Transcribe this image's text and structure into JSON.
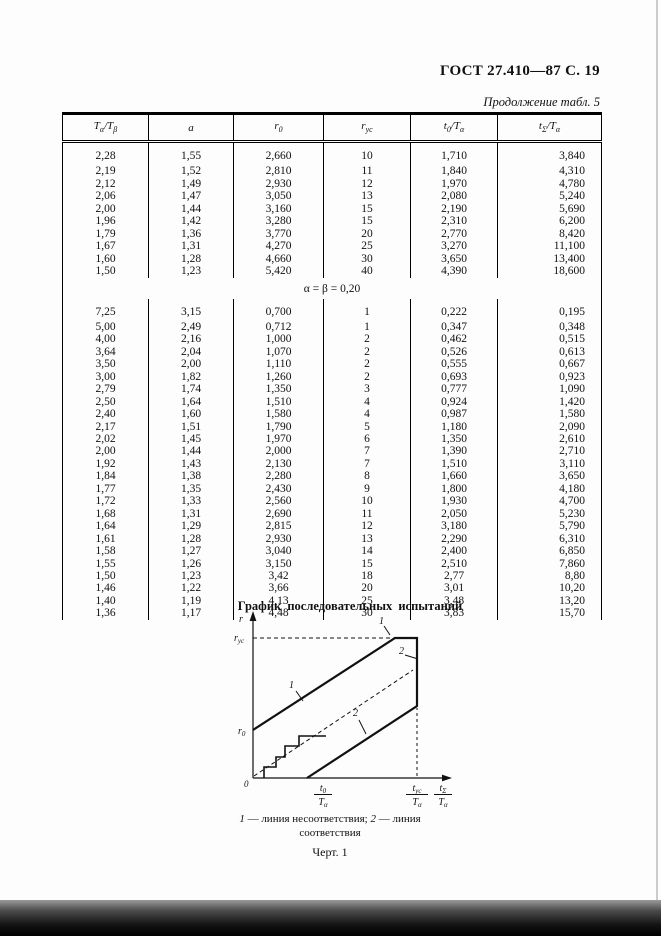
{
  "colors": {
    "page_bg": "#fdfdfd",
    "ink": "#111111"
  },
  "header": {
    "gost": "ГОСТ 27.410—87 С. 19",
    "continuation": "Продолжение табл. 5"
  },
  "table": {
    "columns": [
      [
        {
          "t": "T"
        },
        {
          "s": "α"
        },
        {
          "t": "/T"
        },
        {
          "s": "β"
        }
      ],
      [
        {
          "t": "a"
        }
      ],
      [
        {
          "t": "r"
        },
        {
          "s": "0"
        }
      ],
      [
        {
          "t": "r"
        },
        {
          "s": "ус"
        }
      ],
      [
        {
          "t": "t"
        },
        {
          "s": "0"
        },
        {
          "t": "/T"
        },
        {
          "s": "α"
        }
      ],
      [
        {
          "t": "t"
        },
        {
          "s": "Σ"
        },
        {
          "t": "/T"
        },
        {
          "s": "α"
        }
      ]
    ],
    "sections": [
      {
        "label": null,
        "rows": [
          [
            "2,28",
            "1,55",
            "2,660",
            "10",
            "1,710",
            "3,840"
          ],
          [
            "2,19",
            "1,52",
            "2,810",
            "11",
            "1,840",
            "4,310"
          ],
          [
            "2,12",
            "1,49",
            "2,930",
            "12",
            "1,970",
            "4,780"
          ],
          [
            "2,06",
            "1,47",
            "3,050",
            "13",
            "2,080",
            "5,240"
          ],
          [
            "2,00",
            "1,44",
            "3,160",
            "15",
            "2,190",
            "5,690"
          ],
          [
            "1,96",
            "1,42",
            "3,280",
            "15",
            "2,310",
            "6,200"
          ],
          [
            "1,79",
            "1,36",
            "3,770",
            "20",
            "2,770",
            "8,420"
          ],
          [
            "1,67",
            "1,31",
            "4,270",
            "25",
            "3,270",
            "11,100"
          ],
          [
            "1,60",
            "1,28",
            "4,660",
            "30",
            "3,650",
            "13,400"
          ],
          [
            "1,50",
            "1,23",
            "5,420",
            "40",
            "4,390",
            "18,600"
          ]
        ]
      },
      {
        "label": "α = β = 0,20",
        "rows": [
          [
            "7,25",
            "3,15",
            "0,700",
            "1",
            "0,222",
            "0,195"
          ],
          [
            "5,00",
            "2,49",
            "0,712",
            "1",
            "0,347",
            "0,348"
          ],
          [
            "4,00",
            "2,16",
            "1,000",
            "2",
            "0,462",
            "0,515"
          ],
          [
            "3,64",
            "2,04",
            "1,070",
            "2",
            "0,526",
            "0,613"
          ],
          [
            "3,50",
            "2,00",
            "1,110",
            "2",
            "0,555",
            "0,667"
          ],
          [
            "3,00",
            "1,82",
            "1,260",
            "2",
            "0,693",
            "0,923"
          ],
          [
            "2,79",
            "1,74",
            "1,350",
            "3",
            "0,777",
            "1,090"
          ],
          [
            "2,50",
            "1,64",
            "1,510",
            "4",
            "0,924",
            "1,420"
          ],
          [
            "2,40",
            "1,60",
            "1,580",
            "4",
            "0,987",
            "1,580"
          ],
          [
            "2,17",
            "1,51",
            "1,790",
            "5",
            "1,180",
            "2,090"
          ],
          [
            "2,02",
            "1,45",
            "1,970",
            "6",
            "1,350",
            "2,610"
          ],
          [
            "2,00",
            "1,44",
            "2,000",
            "7",
            "1,390",
            "2,710"
          ],
          [
            "1,92",
            "1,43",
            "2,130",
            "7",
            "1,510",
            "3,110"
          ],
          [
            "1,84",
            "1,38",
            "2,280",
            "8",
            "1,660",
            "3,650"
          ],
          [
            "1,77",
            "1,35",
            "2,430",
            "9",
            "1,800",
            "4,180"
          ],
          [
            "1,72",
            "1,33",
            "2,560",
            "10",
            "1,930",
            "4,700"
          ],
          [
            "1,68",
            "1,31",
            "2,690",
            "11",
            "2,050",
            "5,230"
          ],
          [
            "1,64",
            "1,29",
            "2,815",
            "12",
            "3,180",
            "5,790"
          ],
          [
            "1,61",
            "1,28",
            "2,930",
            "13",
            "2,290",
            "6,310"
          ],
          [
            "1,58",
            "1,27",
            "3,040",
            "14",
            "2,400",
            "6,850"
          ],
          [
            "1,55",
            "1,26",
            "3,150",
            "15",
            "2,510",
            "7,860"
          ],
          [
            "1,50",
            "1,23",
            "3,42",
            "18",
            "2,77",
            "8,80"
          ],
          [
            "1,46",
            "1,22",
            "3,66",
            "20",
            "3,01",
            "10,20"
          ],
          [
            "1,40",
            "1,19",
            "4,13",
            "25",
            "3,48",
            "13,20"
          ],
          [
            "1,36",
            "1,17",
            "4,48",
            "30",
            "3,83",
            "15,70"
          ]
        ]
      }
    ]
  },
  "figure": {
    "title": "График последовательных испытаний",
    "y_axis_label": "r",
    "origin_label": "0",
    "r_us": {
      "base": "r",
      "sub": "ус"
    },
    "r_0": {
      "base": "r",
      "sub": "0"
    },
    "x_fracs": [
      {
        "num": "t",
        "num_sub": "0",
        "den": "T",
        "den_sub": "α"
      },
      {
        "num": "t",
        "num_sub": "ус",
        "den": "T",
        "den_sub": "α"
      },
      {
        "num": "t",
        "num_sub": "Σ",
        "den": "T",
        "den_sub": "α"
      }
    ],
    "line1_label": "1",
    "line2_label": "2",
    "caption_line1": [
      {
        "t": "1",
        "i": true
      },
      {
        "t": " — линия несоответствия; "
      },
      {
        "t": "2",
        "i": true
      },
      {
        "t": " — линия"
      }
    ],
    "caption_line2": [
      {
        "t": "соответствия"
      }
    ],
    "fig_label": "Черт. 1"
  }
}
